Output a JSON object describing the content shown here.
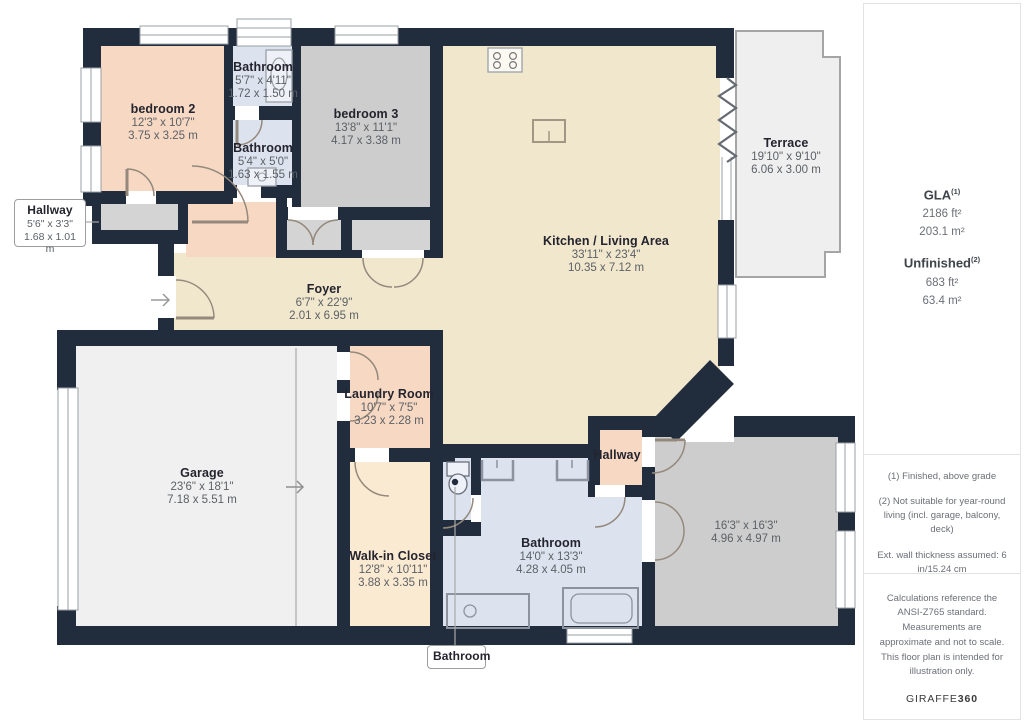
{
  "rooms": {
    "bedroom2": {
      "name": "bedroom 2",
      "imperial": "12'3\" x 10'7\"",
      "metric": "3.75 x 3.25 m"
    },
    "bathroom_top": {
      "name": "Bathroom",
      "imperial": "5'7\" x 4'11\"",
      "metric": "1.72 x 1.50 m"
    },
    "bathroom_mid": {
      "name": "Bathroom",
      "imperial": "5'4\" x 5'0\"",
      "metric": "1.63 x 1.55 m"
    },
    "bedroom3": {
      "name": "bedroom 3",
      "imperial": "13'8\" x 11'1\"",
      "metric": "4.17 x 3.38 m"
    },
    "kitchen_living": {
      "name": "Kitchen / Living Area",
      "imperial": "33'11\" x 23'4\"",
      "metric": "10.35 x 7.12 m"
    },
    "terrace": {
      "name": "Terrace",
      "imperial": "19'10\" x 9'10\"",
      "metric": "6.06 x 3.00 m"
    },
    "hallway_callout": {
      "name": "Hallway",
      "imperial": "5'6\" x 3'3\"",
      "metric": "1.68 x 1.01 m"
    },
    "foyer": {
      "name": "Foyer",
      "imperial": "6'7\" x 22'9\"",
      "metric": "2.01 x 6.95 m"
    },
    "laundry": {
      "name": "Laundry Room",
      "imperial": "10'7\" x 7'5\"",
      "metric": "3.23 x 2.28 m"
    },
    "garage": {
      "name": "Garage",
      "imperial": "23'6\" x 18'1\"",
      "metric": "7.18 x 5.51 m"
    },
    "walk_in_closet": {
      "name": "Walk-in Closet",
      "imperial": "12'8\" x 10'11\"",
      "metric": "3.88 x 3.35 m"
    },
    "bathroom_main": {
      "name": "Bathroom",
      "imperial": "14'0\" x 13'3\"",
      "metric": "4.28 x 4.05 m"
    },
    "hallway_small": {
      "name": "Hallway"
    },
    "unnamed_room": {
      "imperial": "16'3\" x 16'3\"",
      "metric": "4.96 x 4.97 m"
    },
    "bathroom_callout": {
      "name": "Bathroom"
    }
  },
  "sidebar": {
    "gla_label": "GLA",
    "gla_sup": "(1)",
    "gla_ft": "2186 ft²",
    "gla_m": "203.1 m²",
    "unfinished_label": "Unfinished",
    "unfinished_sup": "(2)",
    "unfinished_ft": "683 ft²",
    "unfinished_m": "63.4 m²",
    "note1": "(1) Finished, above grade",
    "note2": "(2) Not suitable for year-round living (incl. garage, balcony, deck)",
    "note3": "Ext. wall thickness assumed: 6 in/15.24 cm",
    "disclaimer": "Calculations reference the ANSI-Z765 standard. Measurements are approximate and not to scale. This floor plan is intended for illustration only.",
    "brand_name": "GIRAFFE",
    "brand_number": "360"
  },
  "colors": {
    "wall": "#212c3d",
    "living_beige": "#f1e7cd",
    "bedroom_pink": "#f6d8c3",
    "room_gray": "#cdcdcd",
    "bathroom_blue": "#dde3ee",
    "closet_cream": "#fbead2",
    "terrace_gray": "#efefef"
  }
}
